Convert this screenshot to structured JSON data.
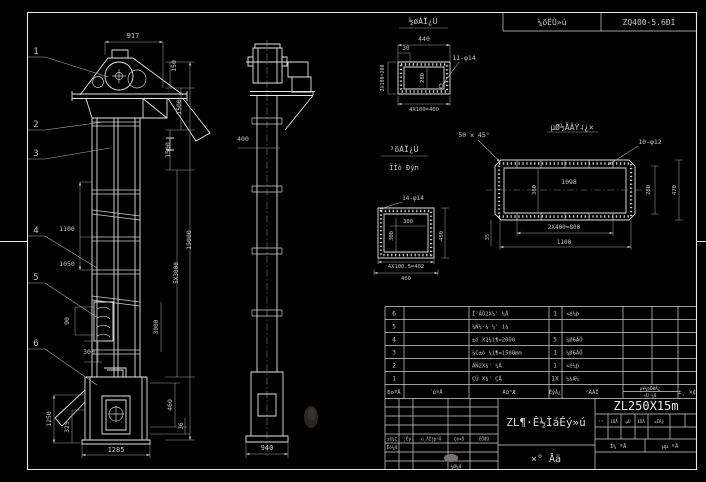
{
  "drawing": {
    "model": "ZL250X15m",
    "title_main": "ZL¶·Ê½ÌáÉý»ú",
    "title_sub": "×°  Åä",
    "header_strip": {
      "left": "¼õËÙ»ú",
      "right": "ZQ400-5.6ÐÍ"
    }
  },
  "balloons": [
    "1",
    "2",
    "3",
    "4",
    "5",
    "6"
  ],
  "annotations": [
    {
      "t": "917",
      "x": 133,
      "y": 38,
      "s": 7
    },
    {
      "t": "150",
      "x": 176,
      "y": 66,
      "r": -90,
      "s": 6.5
    },
    {
      "t": "1500",
      "x": 181,
      "y": 107,
      "r": -90,
      "s": 6.5
    },
    {
      "t": "1500",
      "x": 170,
      "y": 150,
      "r": -90,
      "s": 6.5
    },
    {
      "t": "15000",
      "x": 191,
      "y": 240,
      "r": -90,
      "s": 6.5
    },
    {
      "t": "5X3000",
      "x": 178,
      "y": 273,
      "r": -90,
      "s": 6
    },
    {
      "t": "3000",
      "x": 158,
      "y": 327,
      "r": -90,
      "s": 6
    },
    {
      "t": "460",
      "x": 172,
      "y": 405,
      "r": -90,
      "s": 6.5
    },
    {
      "t": "36",
      "x": 183,
      "y": 426,
      "r": -90,
      "s": 6
    },
    {
      "t": "1100",
      "x": 67,
      "y": 231,
      "s": 6.5
    },
    {
      "t": "1050",
      "x": 67,
      "y": 266,
      "s": 6.5
    },
    {
      "t": "90",
      "x": 69,
      "y": 321,
      "r": -90,
      "s": 6.5
    },
    {
      "t": "300",
      "x": 89,
      "y": 354,
      "s": 6.5
    },
    {
      "t": "1250",
      "x": 51,
      "y": 419,
      "r": -90,
      "s": 6.5
    },
    {
      "t": "325",
      "x": 69,
      "y": 427,
      "r": -90,
      "s": 6.5
    },
    {
      "t": "1285",
      "x": 116,
      "y": 452,
      "s": 7
    },
    {
      "t": "400",
      "x": 243,
      "y": 141,
      "s": 6.5
    },
    {
      "t": "940",
      "x": 267,
      "y": 450,
      "s": 7
    },
    {
      "t": "½øÁÏ¿Ú",
      "x": 423,
      "y": 24,
      "s": 8
    },
    {
      "t": "440",
      "x": 424,
      "y": 41,
      "s": 6.5
    },
    {
      "t": "30",
      "x": 406,
      "y": 50,
      "s": 6
    },
    {
      "t": "11-φ14",
      "x": 464,
      "y": 60,
      "s": 6.5
    },
    {
      "t": "2X100=200",
      "x": 384,
      "y": 78,
      "r": -90,
      "s": 5
    },
    {
      "t": "280",
      "x": 424,
      "y": 78,
      "r": -90,
      "s": 5.5
    },
    {
      "t": "4X100=400",
      "x": 424,
      "y": 111,
      "s": 5.5
    },
    {
      "t": "³öÁÏ¿Ú",
      "x": 404,
      "y": 152,
      "s": 8
    },
    {
      "t": "ÏÌò Ðýת",
      "x": 404,
      "y": 170,
      "s": 7
    },
    {
      "t": "14-φ14",
      "x": 413,
      "y": 200,
      "s": 6
    },
    {
      "t": "300",
      "x": 408,
      "y": 223,
      "s": 5.5
    },
    {
      "t": "300",
      "x": 393,
      "y": 236,
      "r": -90,
      "s": 5.5
    },
    {
      "t": "450",
      "x": 443,
      "y": 236,
      "r": -90,
      "s": 5.5
    },
    {
      "t": "4X100.5=402",
      "x": 406,
      "y": 268,
      "s": 5.5
    },
    {
      "t": "460",
      "x": 406,
      "y": 280,
      "s": 5.5
    },
    {
      "t": "µØ½ÅÂÝ˨¿×",
      "x": 572,
      "y": 130,
      "s": 8
    },
    {
      "t": "50 x 45°",
      "x": 474,
      "y": 137,
      "s": 6.5
    },
    {
      "t": "10-φ12",
      "x": 650,
      "y": 144,
      "s": 6.5
    },
    {
      "t": "1098",
      "x": 569,
      "y": 184,
      "s": 6.5
    },
    {
      "t": "360",
      "x": 536,
      "y": 190,
      "r": -90,
      "s": 5.5
    },
    {
      "t": "280",
      "x": 650,
      "y": 190,
      "r": -90,
      "s": 5.5
    },
    {
      "t": "470",
      "x": 676,
      "y": 190,
      "r": -90,
      "s": 5.5
    },
    {
      "t": "2X400=800",
      "x": 564,
      "y": 229,
      "s": 6
    },
    {
      "t": "1100",
      "x": 564,
      "y": 244,
      "s": 6
    },
    {
      "t": "35",
      "x": 489,
      "y": 237,
      "r": -90,
      "s": 5.5
    }
  ],
  "bom": {
    "headers": [
      "ÐòºÅ",
      "´úºÅ",
      "Ãû³Æ",
      "ÊýÁ¿",
      "²ÄÁÏ"
    ],
    "header_weight_top": "µ¥¼þÖØÁ¿",
    "header_weight_bottom": "×Ü ¼Æ",
    "header_remark": "±¸ ×¢",
    "rows": [
      {
        "no": "6",
        "code": "",
        "name": "Î²ÂÖ2X¼' ¼Å",
        "qty": "1",
        "mat": "×é¼þ"
      },
      {
        "no": "5",
        "code": "",
        "name": "¼Ñ¼·¼ ¼' 1¼",
        "qty": "",
        "mat": ""
      },
      {
        "no": "4",
        "code": "",
        "name": "±ó X2¼ì¶=2000",
        "qty": "5",
        "mat": "¼Ø6ÂÖ"
      },
      {
        "no": "3",
        "code": "",
        "name": "¼C±ó ¼ì¶=1500mm",
        "qty": "1",
        "mat": "¼Ø6ÂÖ"
      },
      {
        "no": "2",
        "code": "",
        "name": "ÁÑ2X¼' ¼Å",
        "qty": "1",
        "mat": "×é¼þ"
      },
      {
        "no": "1",
        "code": "",
        "name": "ÇŨ X¼' ÇÅ",
        "qty": "1X",
        "mat": "¼¼Æ¼"
      }
    ]
  },
  "titleblock": {
    "rev_headers": [
      "±ê¼Ç",
      "´¦Êý",
      "¸ü¸ÄÎļþºÅ",
      "Ç©×Ö",
      "ÈÕÆÚ"
    ],
    "sig_design": "Éè¼Æ",
    "sig_check": "¼Ø¼Æ",
    "info_cells": [
      "¹²",
      "1ÕÅ",
      "µÚ",
      "1ÕÅ",
      "±ÈÀý",
      ""
    ],
    "doc_cells": [
      "Í¼ ºÅ",
      "µµ ºÅ"
    ]
  }
}
